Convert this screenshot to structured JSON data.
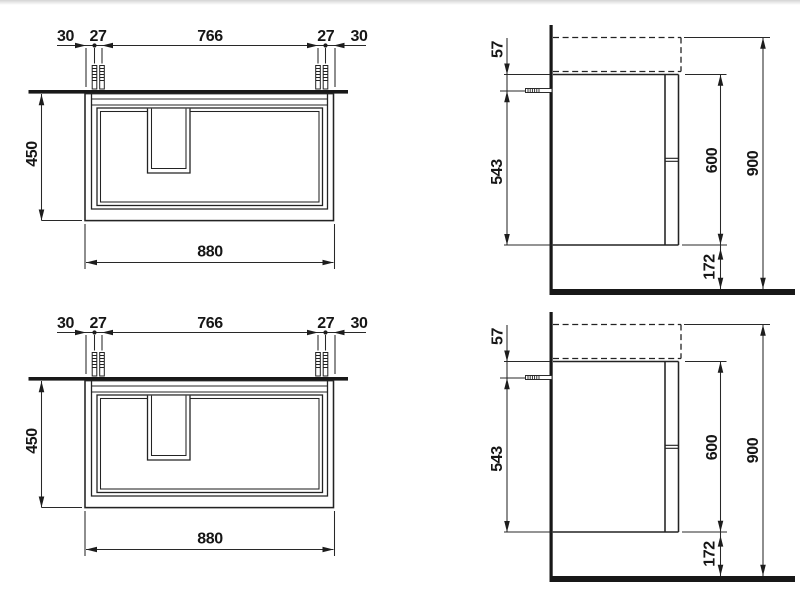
{
  "page": {
    "background_color": "#ffffff",
    "top_edge_shade_color": "#d4d4d4",
    "ink_color": "#1d1d1d"
  },
  "drawing": {
    "rows": [
      {
        "front_view": {
          "dim_left_margin": "30",
          "dim_left_screw_gap": "27",
          "dim_screw_span": "766",
          "dim_right_screw_gap": "27",
          "dim_right_margin": "30",
          "dim_height": "450",
          "dim_width": "880"
        },
        "side_view": {
          "dim_top_to_screw": "57",
          "dim_screw_to_bottom": "543",
          "dim_body_height": "600",
          "dim_total_height": "900",
          "dim_floor_clearance": "172"
        }
      },
      {
        "front_view": {
          "dim_left_margin": "30",
          "dim_left_screw_gap": "27",
          "dim_screw_span": "766",
          "dim_right_screw_gap": "27",
          "dim_right_margin": "30",
          "dim_height": "450",
          "dim_width": "880"
        },
        "side_view": {
          "dim_top_to_screw": "57",
          "dim_screw_to_bottom": "543",
          "dim_body_height": "600",
          "dim_total_height": "900",
          "dim_floor_clearance": "172"
        }
      }
    ]
  }
}
